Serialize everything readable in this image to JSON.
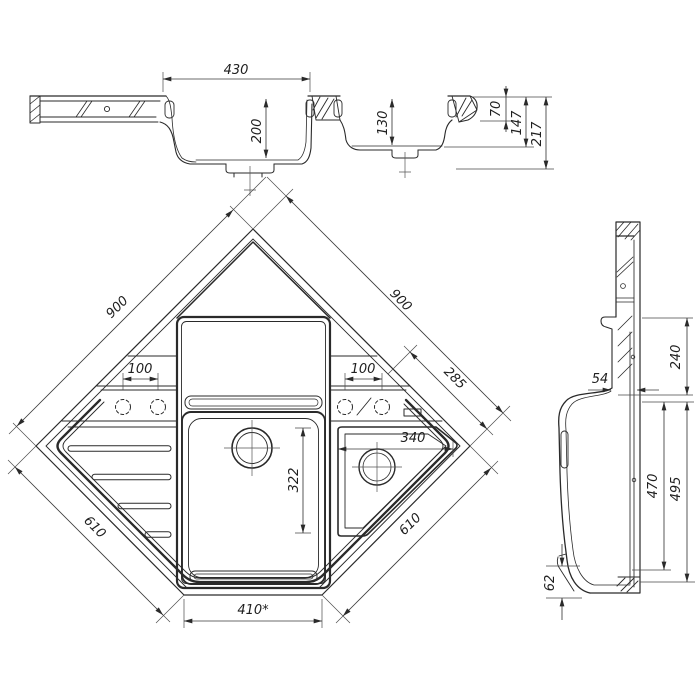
{
  "meta": {
    "type": "technical-drawing",
    "subject": "corner kitchen sink with main bowl, small bowl and drainer wing",
    "units": "mm",
    "line_color": "#2a2a2a",
    "background": "#ffffff"
  },
  "views": {
    "section": {
      "label": "front-section-view",
      "dims": {
        "bowl_width": "430",
        "main_bowl_depth": "200",
        "small_bowl_depth": "130",
        "rim_to_deck": "70",
        "small_bowl_total": "147",
        "overall_height": "217"
      }
    },
    "plan": {
      "label": "top-plan-view",
      "dims": {
        "edge_left": "900",
        "edge_right": "900",
        "tap_spacing_left": "100",
        "tap_spacing_right": "100",
        "corner_to_edge": "285",
        "small_bowl_width": "340",
        "main_bowl_length": "322",
        "front_edge_left": "610",
        "front_edge_right": "610",
        "front_width": "410*"
      }
    },
    "side": {
      "label": "right-profile-view",
      "dims": {
        "ledge_thickness": "54",
        "upper_section": "240",
        "inner_depth": "470",
        "outer_depth": "495",
        "front_lip": "62"
      }
    }
  }
}
